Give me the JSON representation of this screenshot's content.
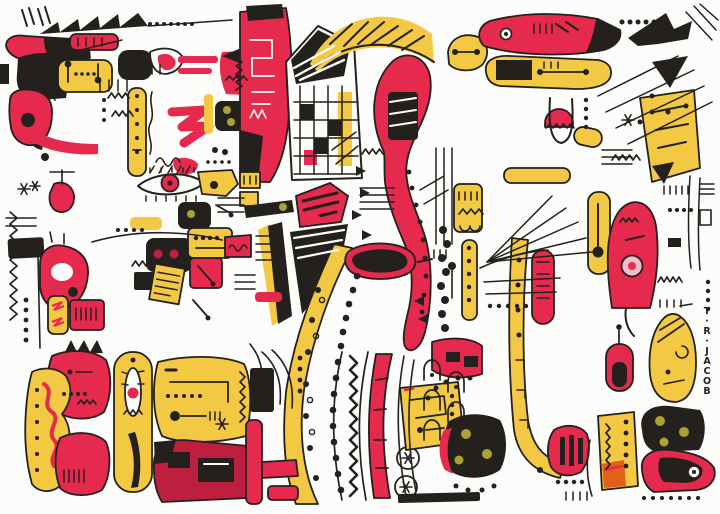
{
  "artwork": {
    "alt": "Abstract hand-drawn ink composition: dense black pen doodles with red and yellow marker shapes on white paper",
    "signature": "T·R·JACOB"
  },
  "palette": {
    "paper": "#fcfcfa",
    "ink": "#24201d",
    "red": "#e62a4d",
    "darkred": "#bf1f3e",
    "yellow": "#f3c843",
    "olive": "#aba233",
    "pink": "#f2bbca",
    "orange": "#e3601b"
  }
}
